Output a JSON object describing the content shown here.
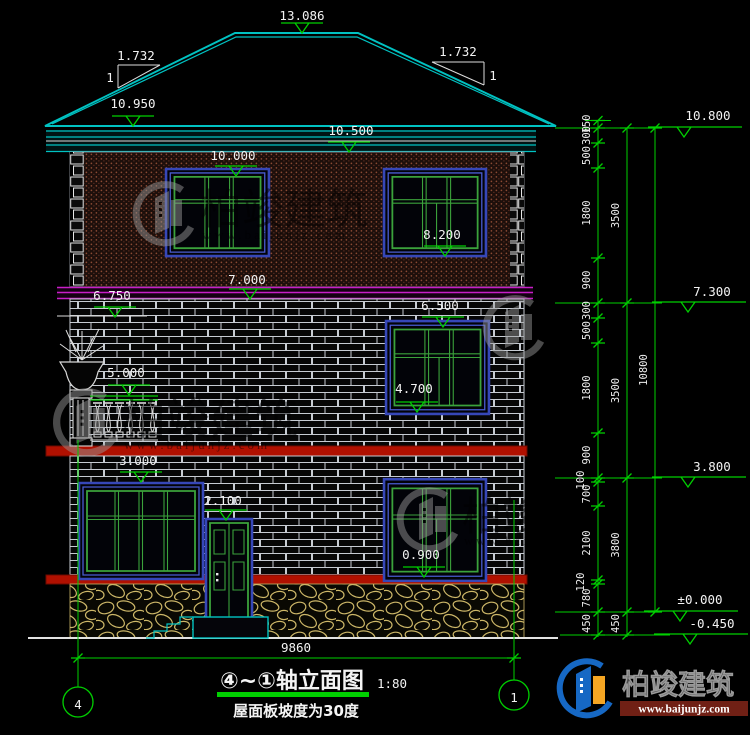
{
  "drawing": {
    "title": "④~①轴立面图",
    "scale": "1:80",
    "note": "屋面板坡度为30度",
    "axis_left": "4",
    "axis_right": "1",
    "overall_width": "9860"
  },
  "roof": {
    "ridge_level": "13.086",
    "slope_run_left": "1.732",
    "slope_rise_left": "1",
    "slope_run_right": "1.732",
    "slope_rise_right": "1"
  },
  "levels": {
    "eave_top": "10.950",
    "eave": "10.500",
    "f3_window_head": "10.000",
    "f3_window_sill": "8.200",
    "band_top": "7.000",
    "band_bottom": "6.750",
    "f2_window_head": "6.500",
    "balcony_rail": "5.000",
    "f2_window_sill": "4.700",
    "f1_window_head": "3.000",
    "door_head": "2.100",
    "f1_window_sill": "0.900"
  },
  "right_elevations": [
    "10.800",
    "7.300",
    "3.800",
    "±0.000",
    "-0.450"
  ],
  "dim_segments": [
    "150",
    "300",
    "500",
    "1800",
    "900",
    "300",
    "500",
    "1800",
    "900",
    "100",
    "700",
    "2100",
    "120",
    "780",
    "450"
  ],
  "dim_groups": [
    "3500",
    "3500",
    "3800",
    "450"
  ],
  "dim_total": "10800",
  "watermark": {
    "brand": "柏竣建筑",
    "url": "www.baijunjz.com"
  },
  "logo": {
    "brand": "柏竣建筑",
    "url": "www.baijunjz.com"
  }
}
